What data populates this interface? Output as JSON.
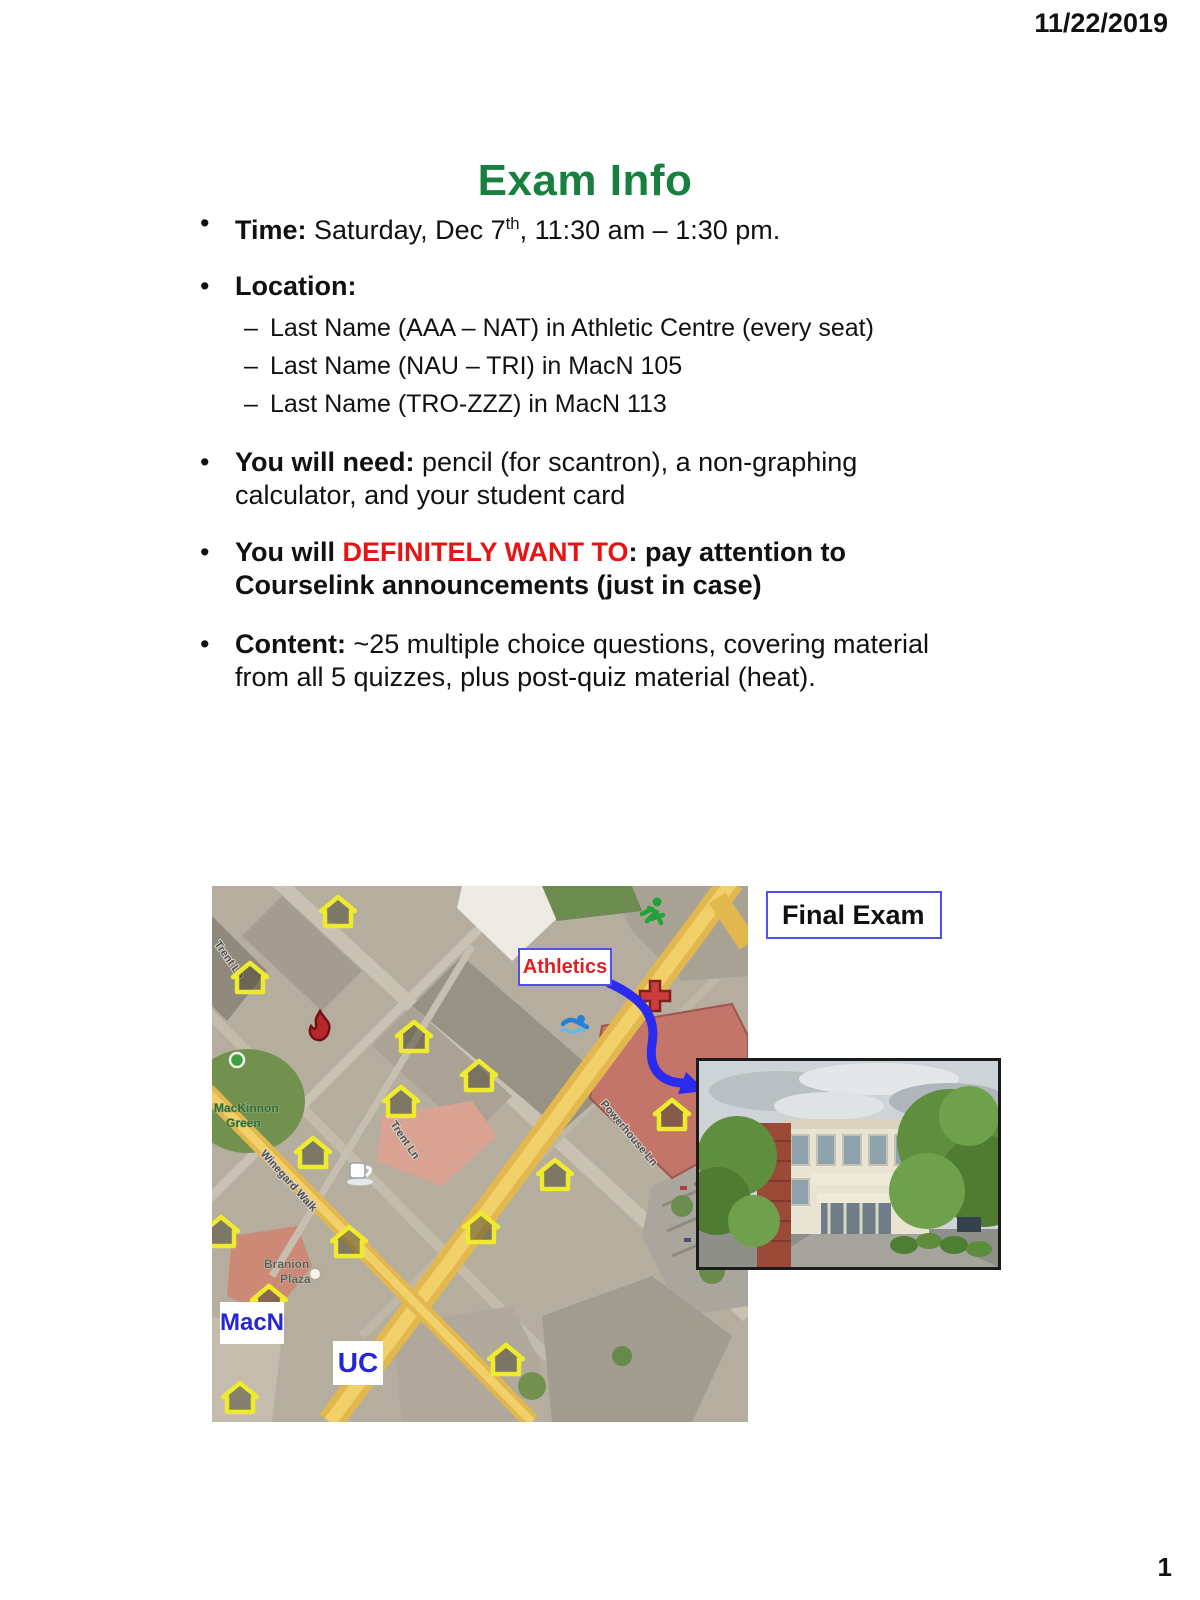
{
  "header": {
    "date": "11/22/2019"
  },
  "footer": {
    "page_number": "1"
  },
  "slide": {
    "title": "Exam Info",
    "title_color": "#17803f",
    "time": {
      "label": "Time:",
      "text1": " Saturday, Dec 7",
      "sup": "th",
      "text2": ", 11:30 am – 1:30 pm."
    },
    "location": {
      "label": "Location:",
      "items": [
        "Last Name (AAA – NAT) in Athletic Centre (every seat)",
        "Last Name (NAU – TRI) in MacN 105",
        "Last Name (TRO-ZZZ) in MacN 113"
      ]
    },
    "need": {
      "label": "You will need:",
      "text": " pencil (for scantron), a non-graphing calculator, and your student card"
    },
    "want": {
      "prefix": "You will ",
      "highlight": "DEFINITELY WANT TO",
      "colon": ":",
      "text": " pay attention to Courselink announcements (just in case)",
      "highlight_color": "#e81414"
    },
    "content": {
      "label": "Content:",
      "text": " ~25 multiple choice questions, covering material from all 5 quizzes, plus post-quiz material (heat)."
    }
  },
  "map": {
    "callout": "Final Exam",
    "labels": {
      "athletics": "Athletics",
      "macn": "MacN",
      "uc": "UC"
    },
    "streets": {
      "trent": "Trent Ln",
      "trent_edge": "Trent Ln",
      "powerhouse": "Powerhouse Ln",
      "winegard": "Winegard Walk"
    },
    "areas": {
      "mackinnon_line1": "MacKinnon",
      "mackinnon_line2": "Green",
      "branion_line1": "Branion",
      "branion_line2": "Plaza"
    },
    "icons": {
      "house_marker": "house-marker",
      "runner": "runner",
      "medical_cross": "medical-cross",
      "swimmer": "swimmer",
      "flame": "flame",
      "coffee_cup": "coffee-cup",
      "tree": "tree",
      "route_arrow": "route-arrow"
    },
    "colors": {
      "callout_border_blue": "#5050f0",
      "label_blue": "#2626d8",
      "athletics_red": "#e02020",
      "arrow_blue": "#2a2af0",
      "road_yellow": "#e2b84e"
    }
  }
}
